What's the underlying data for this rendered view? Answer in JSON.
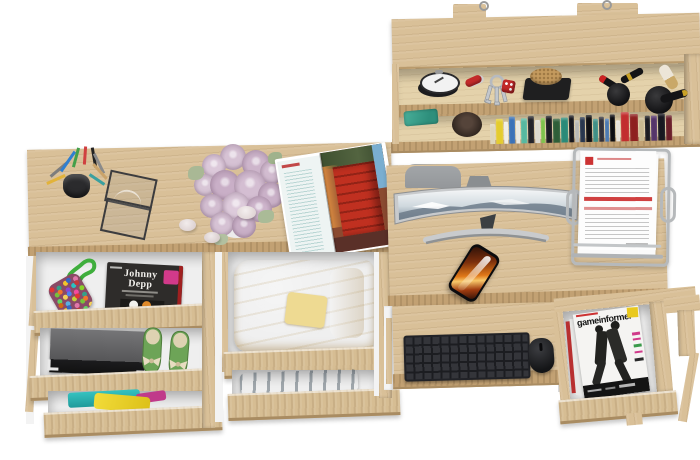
{
  "scene": {
    "background": "#ffffff",
    "view": "top-down render of a light-oak home office set with wall shelf, two desks and open drawers"
  },
  "text": {
    "johnny_depp": "Johnny Depp",
    "gameinformer": "gameinformer"
  },
  "shelf": {
    "objects": [
      "mounting brackets",
      "alarm clock",
      "red pocket knife",
      "key ring with keys",
      "red dice keychain",
      "cork coaster on black tray",
      "lipsticks",
      "two round makeup brushes",
      "row of books",
      "teal pouch",
      "wooden bowl"
    ],
    "books": [
      {
        "w": 5,
        "h": 20,
        "c": "#ded6b8"
      },
      {
        "w": 7,
        "h": 25,
        "c": "#e4cc2e"
      },
      {
        "w": 4,
        "h": 22,
        "c": "#f0ede4"
      },
      {
        "w": 6,
        "h": 27,
        "c": "#3a72b8"
      },
      {
        "w": 4,
        "h": 23,
        "c": "#e8e8e2"
      },
      {
        "w": 6,
        "h": 25,
        "c": "#57b8a0"
      },
      {
        "w": 6,
        "h": 27,
        "c": "#24242a"
      },
      {
        "w": 5,
        "h": 23,
        "c": "#dddad0"
      },
      {
        "w": 4,
        "h": 25,
        "c": "#7ec24a"
      },
      {
        "w": 6,
        "h": 27,
        "c": "#1c1c22"
      },
      {
        "w": 7,
        "h": 24,
        "c": "#2e5e38"
      },
      {
        "w": 7,
        "h": 25,
        "c": "#2a8a78"
      },
      {
        "w": 5,
        "h": 27,
        "c": "#17171d"
      },
      {
        "w": 4,
        "h": 22,
        "c": "#b8b8b4"
      },
      {
        "w": 5,
        "h": 25,
        "c": "#28364e"
      },
      {
        "w": 6,
        "h": 27,
        "c": "#101014"
      },
      {
        "w": 5,
        "h": 23,
        "c": "#3f8f86"
      },
      {
        "w": 5,
        "h": 25,
        "c": "#30303a"
      },
      {
        "w": 4,
        "h": 23,
        "c": "#4a78b0"
      },
      {
        "w": 5,
        "h": 27,
        "c": "#0c0c10"
      },
      {
        "w": 4,
        "h": 21,
        "c": "#e6e2da"
      },
      {
        "w": 8,
        "h": 29,
        "c": "#c22e2e"
      },
      {
        "w": 8,
        "h": 27,
        "c": "#8e2020"
      },
      {
        "w": 5,
        "h": 23,
        "c": "#c8b890"
      },
      {
        "w": 5,
        "h": 25,
        "c": "#1a1a20"
      },
      {
        "w": 6,
        "h": 25,
        "c": "#55356a"
      },
      {
        "w": 7,
        "h": 27,
        "c": "#181820"
      },
      {
        "w": 6,
        "h": 25,
        "c": "#6a1e28"
      }
    ]
  },
  "left_desk": {
    "objects": [
      "mesh pen cup with pens",
      "wire photo frame",
      "bouquet of lavender roses",
      "three pebbles",
      "open magazine with red building photos"
    ]
  },
  "left_drawers": {
    "drawer_1": [
      "multicolor pompom bag with green strap",
      "Johnny Depp magazine"
    ],
    "drawer_2": [
      "gray storage box",
      "green ballet flats with bows"
    ],
    "drawer_3": [
      "folded teal, yellow and magenta clothes"
    ],
    "drawer_4": [
      "folded yellow shirt"
    ],
    "drawer_5": [
      "blue jeans"
    ],
    "bag_dot_colors": [
      "#e03434",
      "#35a08a",
      "#f2c52a",
      "#3566c2",
      "#e077aa",
      "#77c23a",
      "#f2752a",
      "#8a46d0",
      "#2ac2c2",
      "#c23a3a",
      "#64d464",
      "#f2d25a",
      "#4a80f2",
      "#f24aa0",
      "#8ad22a",
      "#d06a16",
      "#5ab0e0",
      "#c2d23a"
    ]
  },
  "right_desk": {
    "objects": [
      "gray chair backrest",
      "curved monitor with snowy mountain wallpaper",
      "smartphone with orange fire wallpaper",
      "silver wire document tray with printed papers",
      "pull-out tray with black keyboard and mouse",
      "open side drawer with magazine stack"
    ]
  },
  "palette": {
    "wood": "#d9c098",
    "wood_light": "#e4d2ab",
    "wood_edge": "#c2a173",
    "wood_shadow": "#a98c62",
    "drawer_interior": "#efefef",
    "keyboard": "#34353a",
    "mouse": "#1d1e20",
    "monitor_bezel": "#c8cacc",
    "screen_rock": "#6d7b8a",
    "screen_sky": "#f2f5f6",
    "rose": "#d3bdd1",
    "leaf": "#a9b895",
    "shirt_yellow": "#e9d38a",
    "jeans_blue": "#3a6580",
    "flats_green": "#6da457",
    "box_gray": "#5c5c5e",
    "strap_green": "#3fae3c",
    "phone_orange": "#d06a16",
    "badge_pink": "#d23a8a",
    "badge_yellow": "#e9c91e",
    "accent_red": "#c03030",
    "dice_red": "#c22828",
    "cover_dark": "#2e2c2a",
    "paper": "#fafafa",
    "wire_silver": "#b6b9bb"
  }
}
